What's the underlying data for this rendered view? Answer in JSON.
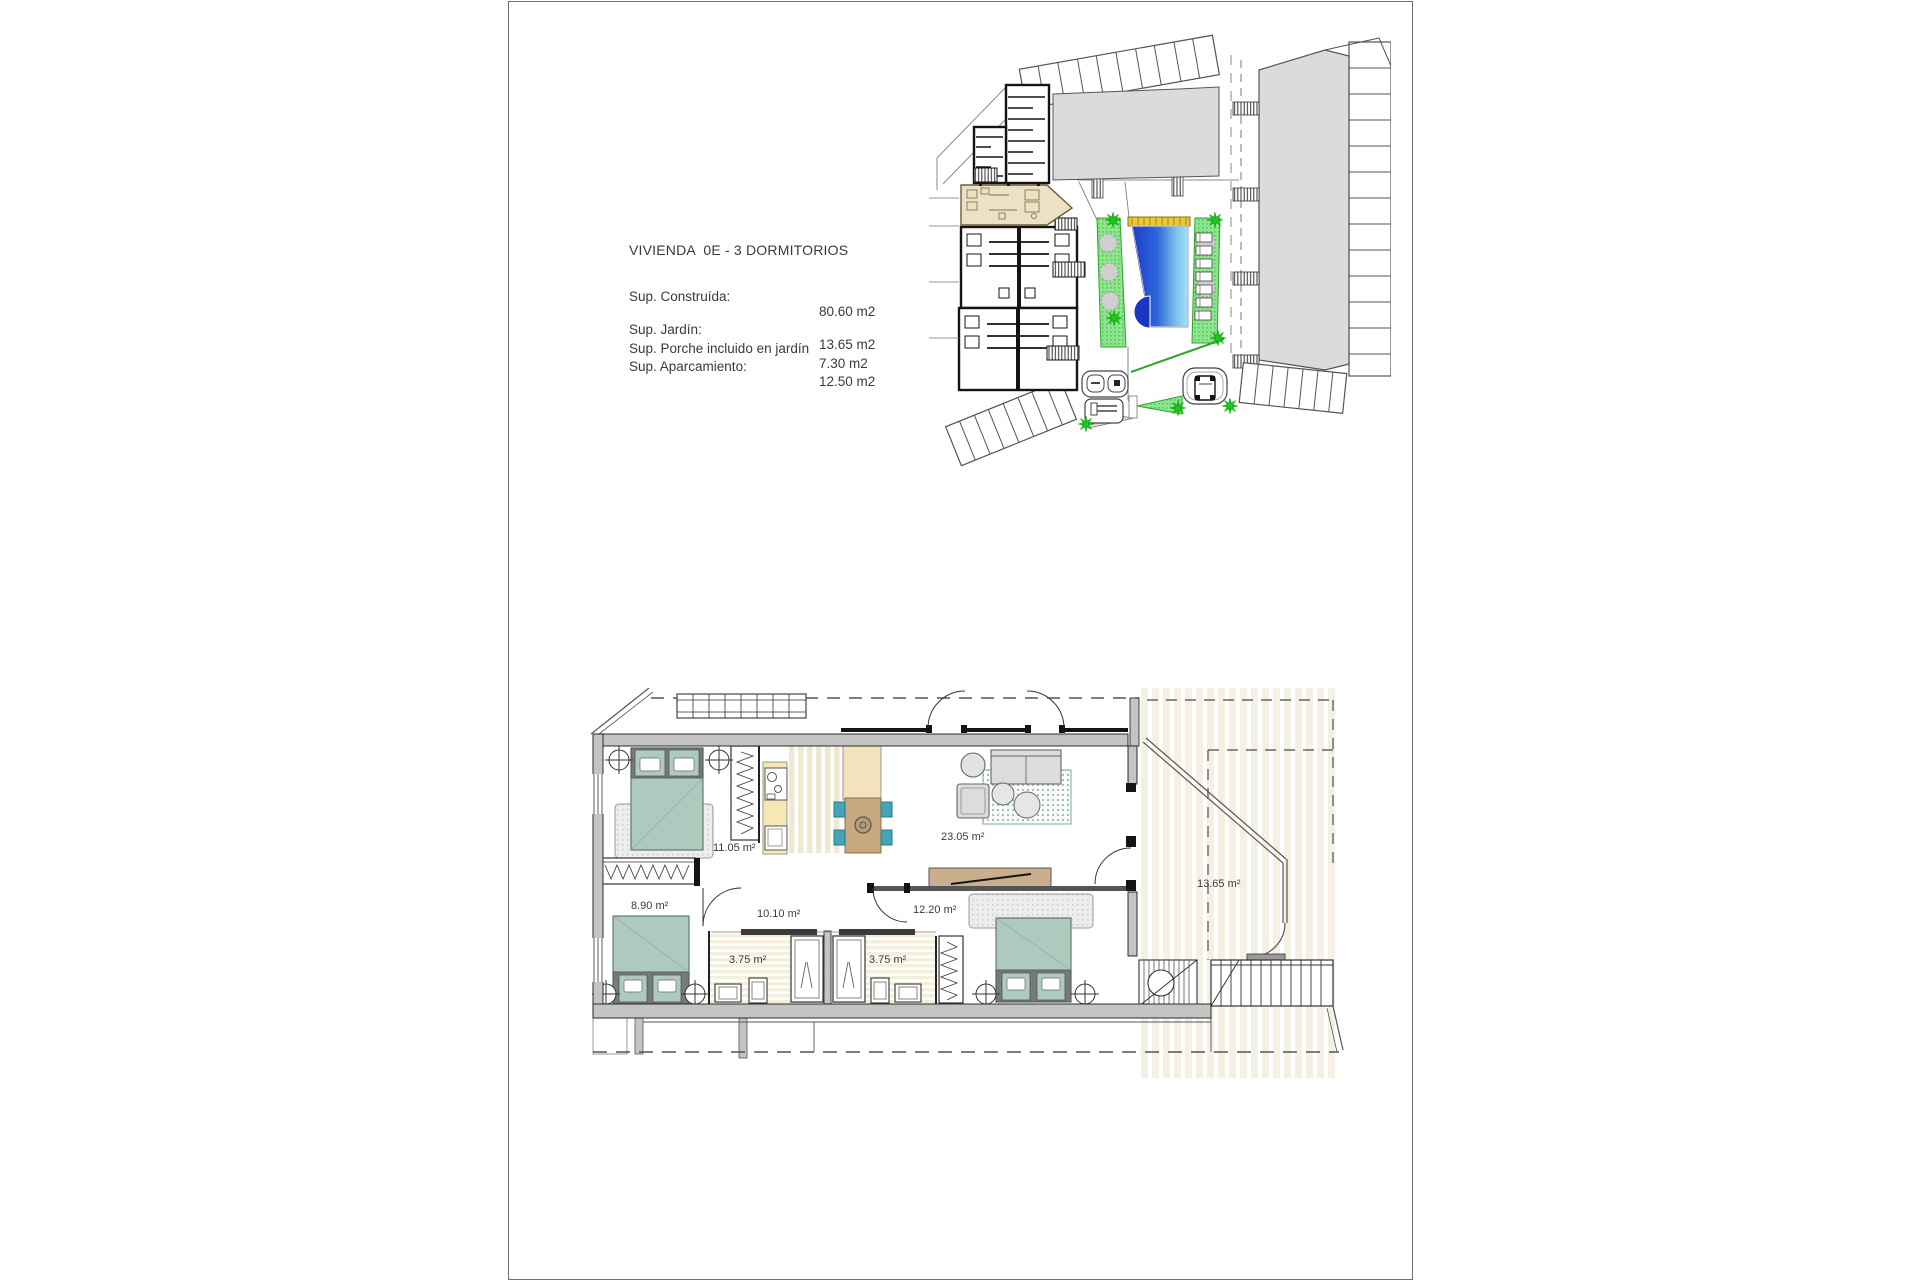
{
  "page": {
    "info": {
      "title": "VIVIENDA  0E - 3 DORMITORIOS",
      "rows": [
        {
          "label": "Sup. Construída:",
          "value": "80.60 m2"
        },
        {
          "label": "Sup. Jardín:",
          "value": "13.65 m2"
        },
        {
          "label": "Sup. Porche incluido en jardín",
          "value": "7.30 m2"
        },
        {
          "label": "Sup. Aparcamiento:",
          "value": "12.50 m2"
        }
      ]
    },
    "floor_plan": {
      "labels": {
        "bedroom1": "11.05 m²",
        "bedroom2": "8.90 m²",
        "hall": "10.10 m²",
        "bath1": "3.75 m²",
        "bath2": "3.75 m²",
        "bedroom3": "12.20 m²",
        "living": "23.05 m²",
        "garden": "13.65 m²"
      }
    },
    "colors": {
      "pool_dark": "#1C3ECC",
      "pool_light": "#A6E0F6",
      "garden_green": "#8FE48F",
      "star_green": "#1EC81E",
      "unit_beige": "#EBE1C4",
      "bed_sage": "#AECABE",
      "counter_yellow": "#F7E7B5",
      "chair_teal": "#47A3B5",
      "building_gray": "#DBDBDB"
    }
  }
}
